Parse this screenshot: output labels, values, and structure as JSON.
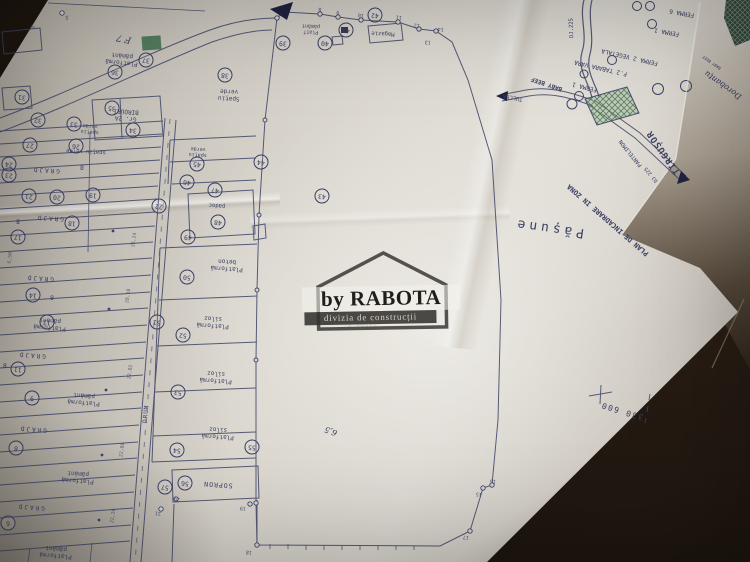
{
  "watermark": {
    "brand": "by RABOTA",
    "division": "divizia de construcții"
  },
  "colors": {
    "ink": "#3a3f63",
    "paper": "#d6d2ca",
    "paper_bright": "#e7e4de",
    "under_sheet": "#ddd9d2",
    "table_dark": "#19120d",
    "hatch_green": "#4e7a52",
    "watermark_bar": "#3a3836"
  },
  "plan": {
    "labels": [
      {
        "t": "F 7",
        "x": 124,
        "y": 38,
        "r": 192,
        "fs": 9,
        "cls": "hand"
      },
      {
        "t": "Platformă pământ",
        "x": 122,
        "y": 58,
        "r": 186,
        "fs": 6,
        "w": 48
      },
      {
        "t": "Gr. 2A BIROURI",
        "x": 126,
        "y": 114,
        "r": 184,
        "fs": 6,
        "w": 42
      },
      {
        "t": "spațiu verde",
        "x": 90,
        "y": 128,
        "r": 184,
        "fs": 5,
        "w": 32
      },
      {
        "t": "spațiu verde",
        "x": 86,
        "y": 151,
        "r": 183,
        "fs": 5.5
      },
      {
        "t": "GRAJD",
        "x": 46,
        "y": 169,
        "r": 184,
        "fs": 6,
        "ls": 2
      },
      {
        "t": "B",
        "x": 82,
        "y": 166,
        "r": 184,
        "fs": 6
      },
      {
        "t": "GRAJD",
        "x": 50,
        "y": 217,
        "r": 184,
        "fs": 6,
        "ls": 2
      },
      {
        "t": "B",
        "x": 18,
        "y": 220,
        "r": 184,
        "fs": 6
      },
      {
        "t": "GRAJD",
        "x": 40,
        "y": 277,
        "r": 184,
        "fs": 6,
        "ls": 2
      },
      {
        "t": "B",
        "x": 52,
        "y": 296,
        "r": 184,
        "fs": 6
      },
      {
        "t": "Platformă pământ",
        "x": 50,
        "y": 323,
        "r": 185,
        "fs": 6,
        "w": 48
      },
      {
        "t": "GRAJD",
        "x": 32,
        "y": 354,
        "r": 185,
        "fs": 6,
        "ls": 2
      },
      {
        "t": "B",
        "x": 5,
        "y": 364,
        "r": 185,
        "fs": 6
      },
      {
        "t": "Platformă pământ",
        "x": 84,
        "y": 398,
        "r": 185,
        "fs": 6,
        "w": 48
      },
      {
        "t": "GRAJD",
        "x": 33,
        "y": 428,
        "r": 185,
        "fs": 6,
        "ls": 2
      },
      {
        "t": "Platformă pământ",
        "x": 78,
        "y": 476,
        "r": 185,
        "fs": 6,
        "w": 48
      },
      {
        "t": "GRAJD",
        "x": 31,
        "y": 506,
        "r": 185,
        "fs": 6,
        "ls": 2
      },
      {
        "t": "Platformă pământ",
        "x": 56,
        "y": 551,
        "r": 185,
        "fs": 6,
        "w": 48
      },
      {
        "t": "spațiu verde",
        "x": 198,
        "y": 151,
        "r": 184,
        "fs": 5,
        "w": 32
      },
      {
        "t": "padoc",
        "x": 217,
        "y": 205,
        "r": 184,
        "fs": 5.5
      },
      {
        "t": "Platformă beton",
        "x": 227,
        "y": 264,
        "r": 184,
        "fs": 6,
        "w": 52
      },
      {
        "t": "Platformă siloz",
        "x": 213,
        "y": 321,
        "r": 184,
        "fs": 6,
        "w": 52
      },
      {
        "t": "Platformă siloz",
        "x": 216,
        "y": 376,
        "r": 184,
        "fs": 6,
        "w": 52
      },
      {
        "t": "Platformă siloz",
        "x": 218,
        "y": 432,
        "r": 184,
        "fs": 6,
        "w": 52
      },
      {
        "t": "SOPRON",
        "x": 218,
        "y": 484,
        "r": 184,
        "fs": 6.5,
        "ls": 1
      },
      {
        "t": "DRUM",
        "x": 147,
        "y": 414,
        "r": 276,
        "fs": 6,
        "ls": 1
      },
      {
        "t": "Spațiu verde",
        "x": 229,
        "y": 94,
        "r": 183,
        "fs": 6,
        "w": 38
      },
      {
        "t": "Platf pământ",
        "x": 311,
        "y": 28,
        "r": 182,
        "fs": 5,
        "w": 36
      },
      {
        "t": "Magazie",
        "x": 383,
        "y": 33,
        "r": 183,
        "fs": 5.5
      },
      {
        "t": "6,5",
        "x": 331,
        "y": 431,
        "r": 200,
        "fs": 8,
        "cls": "hand"
      },
      {
        "t": "siloz furaje",
        "x": 352,
        "y": 324,
        "r": 185,
        "fs": 7,
        "cls": "ghost"
      },
      {
        "t": "Pășune",
        "x": 549,
        "y": 227,
        "r": 188,
        "fs": 13,
        "ls": 4
      },
      {
        "t": "PLAN DE INCADRARE IN ZONA",
        "x": 608,
        "y": 220,
        "r": 221,
        "fs": 7,
        "cls": "bold"
      },
      {
        "t": "TÎRGUȘOR",
        "x": 664,
        "y": 152,
        "r": 235,
        "fs": 9,
        "cls": "bold",
        "ls": 1
      },
      {
        "t": "PANTELIMON",
        "x": 631,
        "y": 153,
        "r": 231,
        "fs": 5.5
      },
      {
        "t": "DJ 225",
        "x": 652,
        "y": 174,
        "r": 231,
        "fs": 5
      },
      {
        "t": "DJ.225",
        "x": 572,
        "y": 28,
        "r": 268,
        "fs": 5.5
      },
      {
        "t": "TULCEA",
        "x": 513,
        "y": 97,
        "r": 190,
        "fs": 5.5
      },
      {
        "t": "BABY BEEF",
        "x": 547,
        "y": 83,
        "r": 199,
        "fs": 6,
        "cls": "bold"
      },
      {
        "t": "FERMA 6",
        "x": 682,
        "y": 12,
        "r": 190,
        "fs": 6
      },
      {
        "t": "FERMA 1",
        "x": 667,
        "y": 31,
        "r": 190,
        "fs": 6
      },
      {
        "t": "FERMA 2 VEGETALA",
        "x": 630,
        "y": 56,
        "r": 193,
        "fs": 6
      },
      {
        "t": "F.2 TABARA VARA",
        "x": 601,
        "y": 67,
        "r": 193,
        "fs": 6
      },
      {
        "t": "FERMA 1",
        "x": 585,
        "y": 86,
        "r": 194,
        "fs": 6
      },
      {
        "t": "330 600",
        "x": 622,
        "y": 411,
        "r": 197,
        "fs": 8,
        "ls": 1.5
      },
      {
        "t": "Dorobanțu",
        "x": 723,
        "y": 85,
        "r": 215,
        "fs": 8,
        "cls": "hand"
      },
      {
        "t": "BABY BEEF",
        "x": 712,
        "y": 62,
        "r": 215,
        "fs": 4
      },
      {
        "t": "26,24",
        "x": 135,
        "y": 240,
        "r": 278,
        "fs": 4.8,
        "cls": "dim"
      },
      {
        "t": "28,18",
        "x": 129,
        "y": 296,
        "r": 278,
        "fs": 4.8,
        "cls": "dim"
      },
      {
        "t": "22,02",
        "x": 131,
        "y": 372,
        "r": 278,
        "fs": 4.8,
        "cls": "dim"
      },
      {
        "t": "22,80",
        "x": 123,
        "y": 450,
        "r": 278,
        "fs": 4.8,
        "cls": "dim"
      },
      {
        "t": "22,20",
        "x": 114,
        "y": 516,
        "r": 278,
        "fs": 4.8,
        "cls": "dim"
      },
      {
        "t": "6,50",
        "x": 11,
        "y": 258,
        "r": 276,
        "fs": 4.8,
        "cls": "dim"
      },
      {
        "t": "50",
        "x": 33,
        "y": 26,
        "r": 186,
        "fs": 4.5,
        "cls": "dim"
      },
      {
        "t": "5",
        "x": 67,
        "y": 16,
        "r": 186,
        "fs": 5,
        "cls": "pt"
      },
      {
        "t": "8",
        "x": 320,
        "y": 8,
        "r": 185,
        "fs": 5,
        "cls": "pt"
      },
      {
        "t": "9",
        "x": 338,
        "y": 11,
        "r": 185,
        "fs": 5,
        "cls": "pt"
      },
      {
        "t": "10",
        "x": 361,
        "y": 14,
        "r": 185,
        "fs": 5,
        "cls": "pt"
      },
      {
        "t": "11",
        "x": 399,
        "y": 16,
        "r": 185,
        "fs": 5,
        "cls": "pt"
      },
      {
        "t": "12",
        "x": 417,
        "y": 24,
        "r": 185,
        "fs": 5,
        "cls": "pt"
      },
      {
        "t": "13",
        "x": 428,
        "y": 41,
        "r": 185,
        "fs": 5,
        "cls": "pt"
      },
      {
        "t": "14",
        "x": 441,
        "y": 28,
        "r": 185,
        "fs": 5,
        "cls": "pt"
      },
      {
        "t": "15",
        "x": 479,
        "y": 493,
        "r": 185,
        "fs": 5,
        "cls": "pt"
      },
      {
        "t": "16",
        "x": 493,
        "y": 480,
        "r": 185,
        "fs": 5,
        "cls": "pt"
      },
      {
        "t": "17",
        "x": 466,
        "y": 536,
        "r": 185,
        "fs": 5,
        "cls": "pt"
      },
      {
        "t": "18",
        "x": 249,
        "y": 551,
        "r": 185,
        "fs": 5,
        "cls": "pt"
      },
      {
        "t": "19",
        "x": 243,
        "y": 507,
        "r": 185,
        "fs": 5,
        "cls": "pt"
      },
      {
        "t": "20",
        "x": 177,
        "y": 498,
        "r": 185,
        "fs": 5,
        "cls": "pt"
      },
      {
        "t": "21",
        "x": 158,
        "y": 512,
        "r": 185,
        "fs": 5,
        "cls": "pt"
      }
    ],
    "circled_numbers": [
      {
        "n": "6",
        "x": 8,
        "y": 523
      },
      {
        "n": "8",
        "x": 16,
        "y": 448
      },
      {
        "n": "9",
        "x": 32,
        "y": 398
      },
      {
        "n": "11",
        "x": 18,
        "y": 369
      },
      {
        "n": "13",
        "x": 47,
        "y": 322
      },
      {
        "n": "14",
        "x": 33,
        "y": 295
      },
      {
        "n": "17",
        "x": 18,
        "y": 237
      },
      {
        "n": "18",
        "x": 72,
        "y": 223
      },
      {
        "n": "19",
        "x": 93,
        "y": 195
      },
      {
        "n": "20",
        "x": 57,
        "y": 197
      },
      {
        "n": "21",
        "x": 29,
        "y": 196
      },
      {
        "n": "22",
        "x": 159,
        "y": 206
      },
      {
        "n": "23",
        "x": 9,
        "y": 175
      },
      {
        "n": "24",
        "x": 9,
        "y": 164
      },
      {
        "n": "26",
        "x": 76,
        "y": 146
      },
      {
        "n": "27",
        "x": 30,
        "y": 145
      },
      {
        "n": "31",
        "x": 22,
        "y": 97
      },
      {
        "n": "32",
        "x": 38,
        "y": 120
      },
      {
        "n": "33",
        "x": 74,
        "y": 124
      },
      {
        "n": "34",
        "x": 133,
        "y": 130
      },
      {
        "n": "35",
        "x": 112,
        "y": 108
      },
      {
        "n": "36",
        "x": 115,
        "y": 72
      },
      {
        "n": "37",
        "x": 146,
        "y": 60
      },
      {
        "n": "38",
        "x": 225,
        "y": 75
      },
      {
        "n": "39",
        "x": 283,
        "y": 43
      },
      {
        "n": "40",
        "x": 325,
        "y": 43
      },
      {
        "n": "41",
        "x": 346,
        "y": 30
      },
      {
        "n": "42",
        "x": 375,
        "y": 15
      },
      {
        "n": "43",
        "x": 322,
        "y": 196
      },
      {
        "n": "44",
        "x": 261,
        "y": 162
      },
      {
        "n": "45",
        "x": 197,
        "y": 164
      },
      {
        "n": "46",
        "x": 187,
        "y": 182
      },
      {
        "n": "47",
        "x": 215,
        "y": 190
      },
      {
        "n": "48",
        "x": 218,
        "y": 222
      },
      {
        "n": "49",
        "x": 188,
        "y": 237
      },
      {
        "n": "50",
        "x": 187,
        "y": 277
      },
      {
        "n": "51",
        "x": 157,
        "y": 322
      },
      {
        "n": "52",
        "x": 183,
        "y": 335
      },
      {
        "n": "53",
        "x": 178,
        "y": 392
      },
      {
        "n": "54",
        "x": 177,
        "y": 450
      },
      {
        "n": "55",
        "x": 252,
        "y": 447
      },
      {
        "n": "56",
        "x": 185,
        "y": 483
      },
      {
        "n": "57",
        "x": 165,
        "y": 487
      }
    ]
  }
}
